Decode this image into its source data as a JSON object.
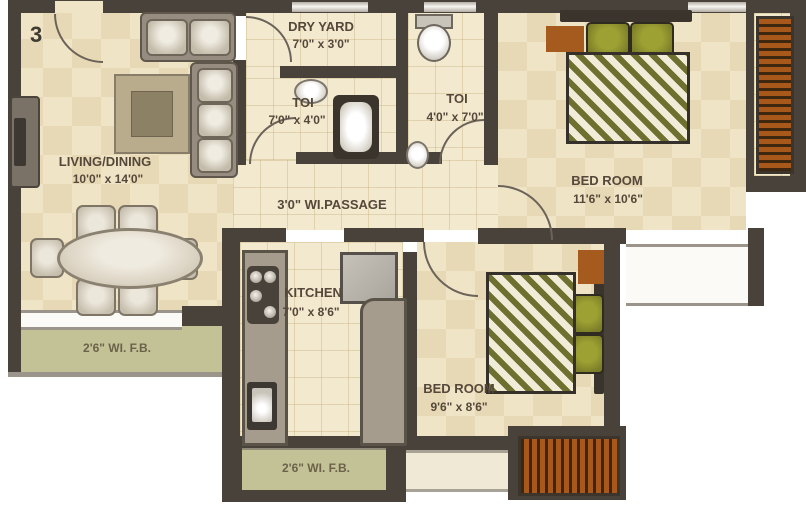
{
  "unit_label": "3",
  "rooms": {
    "living": {
      "label": "LIVING/DINING",
      "dims": "10'0\" x 14'0\""
    },
    "dry_yard": {
      "label": "DRY YARD",
      "dims": "7'0\" x 3'0\""
    },
    "toilet_1": {
      "label": "TOI",
      "dims": "7'0\" x 4'0\""
    },
    "toilet_2": {
      "label": "TOI",
      "dims": "4'0\" x 7'0\""
    },
    "bedroom_1": {
      "label": "BED ROOM",
      "dims": "11'6\" x 10'6\""
    },
    "passage": {
      "label": "3'0\" WI.PASSAGE"
    },
    "kitchen": {
      "label": "KITCHEN",
      "dims": "7'0\" x 8'6\""
    },
    "bedroom_2": {
      "label": "BED ROOM",
      "dims": "9'6\" x 8'6\""
    },
    "flower_bed_left": {
      "label": "2'6\" WI. F.B."
    },
    "flower_bed_bottom": {
      "label": "2'6\" WI. F.B."
    }
  },
  "furniture": [
    "two-seater-sofa",
    "three-seater-sofa",
    "coffee-table",
    "tv-unit",
    "six-seater-dining-table",
    "wash-basin",
    "bathtub",
    "water-closet",
    "small-wash-basin",
    "double-bed-1",
    "wardrobe-bed1",
    "kitchen-platform",
    "gas-stove",
    "kitchen-sink",
    "refrigerator",
    "service-counter",
    "double-bed-2",
    "corner-wardrobe-bed2",
    "wardrobe-bed2"
  ],
  "colors": {
    "wall": "#49423a",
    "floor_tile": "#efe4c5",
    "flower_bed": "#c3c297",
    "wardrobe_wood": "#a9581b",
    "pillow_green": "#8a8c2f",
    "counter_gray": "#a59c8e",
    "label_text": "#55483a",
    "outside": "#ffffff"
  }
}
